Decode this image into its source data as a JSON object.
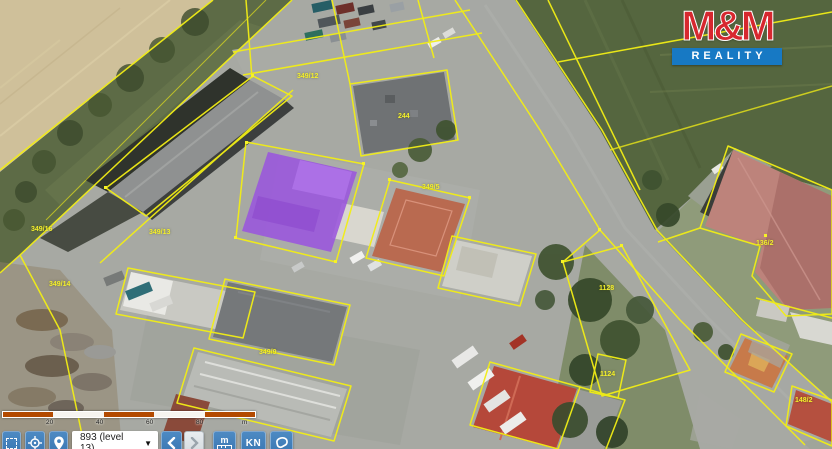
{
  "logo": {
    "title": "M&M",
    "subtitle": "REALITY",
    "title_color": "#d7282f",
    "bar_color": "#1779c4"
  },
  "map": {
    "highlight_color": "#9a55dd",
    "boundary_color": "#f2ee15",
    "parcels": [
      {
        "label": "349/12",
        "x": 297,
        "y": 73
      },
      {
        "label": "244",
        "x": 398,
        "y": 113
      },
      {
        "label": "349/5",
        "x": 422,
        "y": 184
      },
      {
        "label": "349/16",
        "x": 31,
        "y": 226
      },
      {
        "label": "349/13",
        "x": 149,
        "y": 229
      },
      {
        "label": "349/14",
        "x": 49,
        "y": 281
      },
      {
        "label": "349/9",
        "x": 259,
        "y": 349
      },
      {
        "label": "1128",
        "x": 599,
        "y": 285
      },
      {
        "label": "1124",
        "x": 600,
        "y": 371
      },
      {
        "label": "136/2",
        "x": 756,
        "y": 240
      },
      {
        "label": "148/2",
        "x": 795,
        "y": 397
      }
    ]
  },
  "scalebar": {
    "labels": [
      "20",
      "40",
      "60",
      "80"
    ],
    "unit": "m",
    "bar_color": "#b34a00"
  },
  "toolbar": {
    "button_color": "#3e7cb8",
    "zoom_value": "893 (level 13)",
    "measure_label": "m",
    "kn_label": "KN",
    "icons": [
      "dashed-square-icon",
      "crosshair-icon",
      "map-pin-icon",
      "caret-down-icon",
      "chevron-left-icon",
      "chevron-right-icon",
      "ruler-icon",
      "lasso-icon"
    ]
  }
}
